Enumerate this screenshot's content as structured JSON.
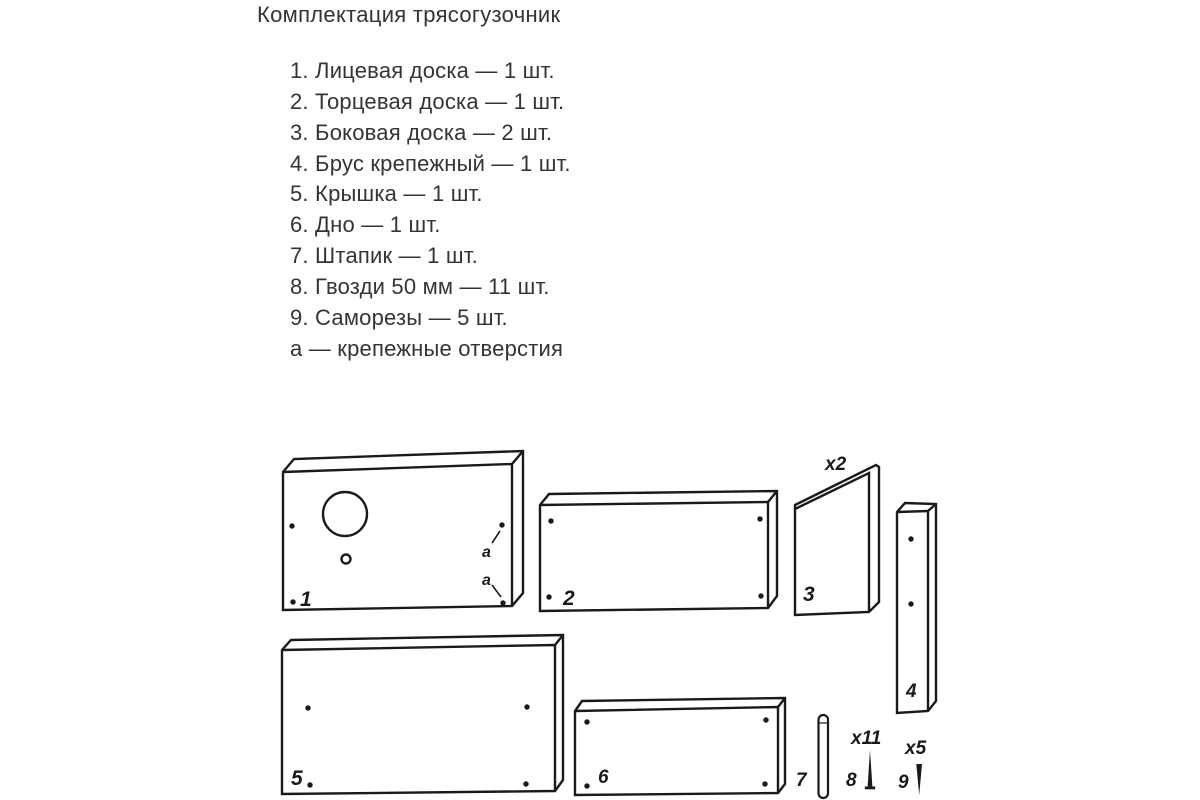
{
  "title": "Комплектация трясогузочник",
  "parts_list": {
    "items": [
      "1. Лицевая доска — 1 шт.",
      "2. Торцевая доска — 1 шт.",
      "3. Боковая доска — 2 шт.",
      "4. Брус крепежный — 1 шт.",
      "5. Крышка — 1 шт.",
      "6. Дно — 1 шт.",
      "7. Штапик — 1 шт.",
      "8. Гвозди 50 мм — 11 шт.",
      "9. Саморезы — 5 шт.",
      "а — крепежные отверстия"
    ]
  },
  "diagram": {
    "labels": {
      "part1": "1",
      "part2": "2",
      "part3": "3",
      "part4": "4",
      "part5": "5",
      "part6": "6",
      "part7": "7",
      "part8": "8",
      "part9": "9",
      "part3_count": "x2",
      "part8_count": "x11",
      "part9_count": "x5",
      "hole_marker_top": "а",
      "hole_marker_bottom": "а"
    }
  },
  "colors": {
    "background": "#ffffff",
    "line": "#1a1a1a",
    "text": "#343434"
  }
}
